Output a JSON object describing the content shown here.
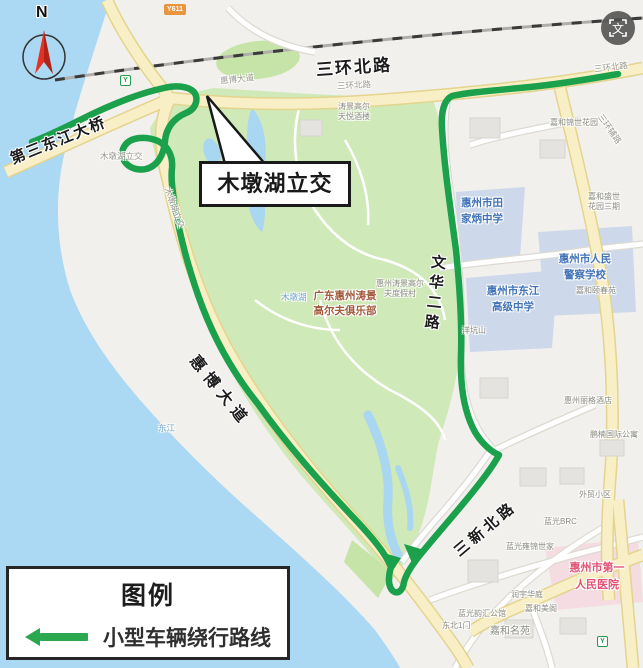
{
  "legend": {
    "title": "图例",
    "route_label": "小型车辆绕行路线"
  },
  "callout": {
    "text": "木墩湖立交"
  },
  "compass": {
    "label": "N"
  },
  "badges": {
    "road": "Y611",
    "translate": "文",
    "transit": "Y"
  },
  "roads": {
    "sanhuan_main": "三环北路",
    "bridge": "第三东江大桥",
    "huibo": "惠博大道",
    "wenhua": "文华二路",
    "sanxin": "三新北路",
    "sanhuan_onroad": "三环北路",
    "sanhuan_onroad2": "三环北路",
    "huibo_onroad": "惠博大道",
    "sanhuan_fulu": "三环辅路",
    "mudun_onroad1": "木墩湖立交",
    "mudun_onroad2": "木墩湖立交"
  },
  "places": {
    "golf_club": "广东惠州涛景\n高尔夫俱乐部",
    "golf_resort": "惠州涛景高尔\n夫度假村",
    "taojing_hotel": "涛景高尔\n天悦酒楼",
    "tianjiabing": "惠州市田\n家炳中学",
    "dongjiang": "惠州市东江\n高级中学",
    "police": "惠州市人民\n警察学校",
    "hospital": "惠州市第一\n人民医院",
    "yangkengshan": "洋坑山",
    "jiahe_jinshi": "嘉和锦世花园",
    "jiahe_shengshi": "嘉和盛世\n花园三期",
    "jiahe_yichun": "嘉和颐春苑",
    "lige_hotel": "惠州丽格酒店",
    "pengnan": "鹏楠国际公寓",
    "waimao": "外贸小区",
    "languang_brc": "蓝光BRC",
    "languang_yongjin": "蓝光雍锦世家",
    "runyu": "润宇华庭",
    "jiahe_meige": "嘉和美阁",
    "languang_yunhui": "蓝光韵汇公馆",
    "dongbei_gate": "东北1门",
    "jiahe_mingyuan": "嘉和名苑"
  },
  "water": {
    "river": "东江",
    "lake": "木墩湖"
  },
  "colors": {
    "route_green": "#1ba04b",
    "water_blue": "#abd8f2",
    "park_green": "#d0e9b8",
    "road_yellow": "#f8efc6",
    "zone_blue": "#cdd9eb",
    "hospital_pink": "#f4dce2",
    "hospital_text": "#e25275",
    "school_text": "#4273b8",
    "golf_text": "#a3593c",
    "legend_arrow": "#29a850"
  }
}
